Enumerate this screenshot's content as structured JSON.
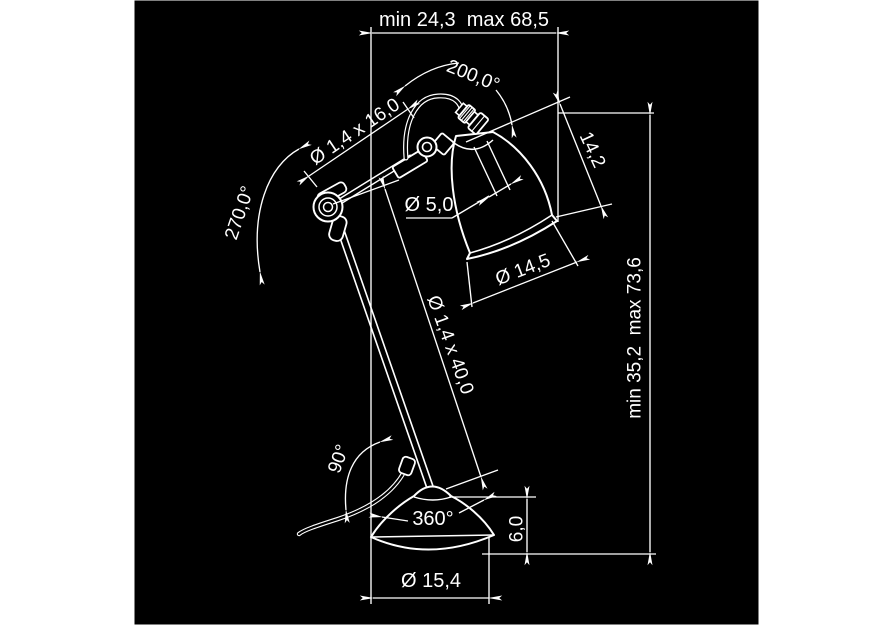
{
  "colors": {
    "page_bg": "#ffffff",
    "drawing_bg": "#000000",
    "line": "#ffffff"
  },
  "dimensions": {
    "top_width": "min 24,3  max 68,5",
    "head_rotation": "200,0°",
    "upper_arm_tube": "Ø 1,4 x 16,0",
    "elbow_rotation": "270,0°",
    "socket_tube_diameter": "Ø 5,0",
    "shade_depth": "14,2",
    "shade_diameter": "Ø 14,5",
    "lower_arm_tube": "Ø 1,4 x 40,0",
    "overall_height": "min 35,2  max 73,6",
    "base_joint_tilt": "90°",
    "base_rotation": "360°",
    "base_height": "6,0",
    "base_diameter": "Ø 15,4"
  }
}
